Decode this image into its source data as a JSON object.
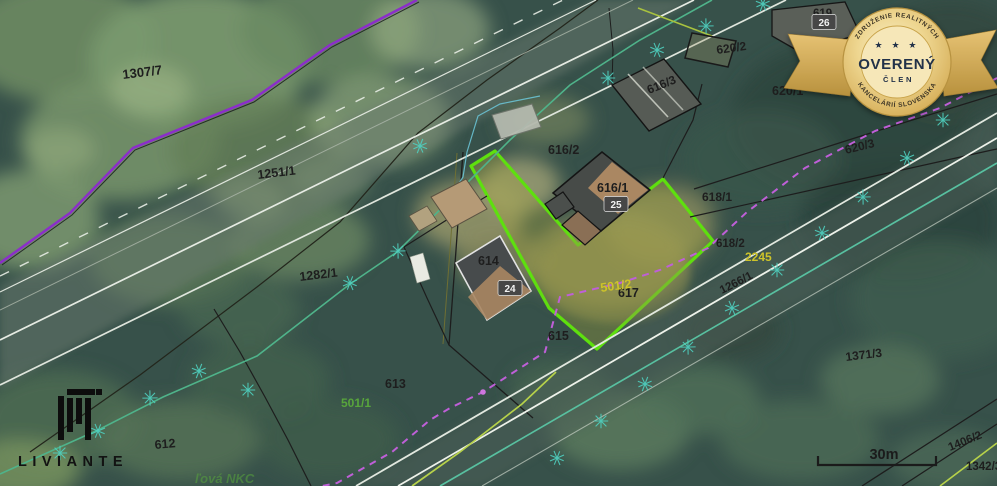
{
  "map": {
    "highlight_color": "#5ee00e",
    "boundary_purple": "#8b2fc9",
    "dashed_magenta": "#bf5fd8",
    "tree_color": "#4fd0c0",
    "label_yellow": "#cdc32a",
    "label_green": "#58a53c",
    "parcel_labels": [
      {
        "text": "1307/7",
        "x": 123,
        "y": 79,
        "color": "#1e1e1e",
        "rot": -7,
        "size": 13
      },
      {
        "text": "1251/1",
        "x": 258,
        "y": 179,
        "color": "#1e1e1e",
        "rot": -7,
        "size": 12.5
      },
      {
        "text": "1282/1",
        "x": 300,
        "y": 281,
        "color": "#1e1e1e",
        "rot": -7,
        "size": 12.5
      },
      {
        "text": "612",
        "x": 155,
        "y": 449,
        "color": "#1e1e1e",
        "rot": -5,
        "size": 12.5
      },
      {
        "text": "613",
        "x": 385,
        "y": 388,
        "color": "#1e1e1e",
        "rot": 0,
        "size": 12.5
      },
      {
        "text": "615",
        "x": 548,
        "y": 340,
        "color": "#1e1e1e",
        "rot": 0,
        "size": 12.5
      },
      {
        "text": "614",
        "x": 478,
        "y": 265,
        "color": "#1e1e1e",
        "rot": 0,
        "size": 12.5
      },
      {
        "text": "616/2",
        "x": 548,
        "y": 154,
        "color": "#1e1e1e",
        "rot": 0,
        "size": 12.5
      },
      {
        "text": "616/1",
        "x": 597,
        "y": 192,
        "color": "#1e1e1e",
        "rot": 0,
        "size": 12.5
      },
      {
        "text": "616/3",
        "x": 649,
        "y": 94,
        "color": "#1e1e1e",
        "rot": -22,
        "size": 12
      },
      {
        "text": "620/2",
        "x": 717,
        "y": 54,
        "color": "#1e1e1e",
        "rot": -8,
        "size": 12
      },
      {
        "text": "620/1",
        "x": 772,
        "y": 95,
        "color": "#1e1e1e",
        "rot": 0,
        "size": 12.5
      },
      {
        "text": "620/3",
        "x": 846,
        "y": 154,
        "color": "#1e1e1e",
        "rot": -14,
        "size": 12
      },
      {
        "text": "619",
        "x": 813,
        "y": 17,
        "color": "#1e1e1e",
        "rot": 0,
        "size": 11.5
      },
      {
        "text": "618/1",
        "x": 702,
        "y": 201,
        "color": "#1e1e1e",
        "rot": 0,
        "size": 12
      },
      {
        "text": "618/2",
        "x": 716,
        "y": 247,
        "color": "#1e1e1e",
        "rot": 0,
        "size": 11.5
      },
      {
        "text": "617",
        "x": 618,
        "y": 297,
        "color": "#1e1e1e",
        "rot": 0,
        "size": 12.5
      },
      {
        "text": "1266/1",
        "x": 722,
        "y": 294,
        "color": "#1e1e1e",
        "rot": -27,
        "size": 11.5
      },
      {
        "text": "1371/3",
        "x": 846,
        "y": 361,
        "color": "#1e1e1e",
        "rot": -7,
        "size": 12
      },
      {
        "text": "1406/2",
        "x": 950,
        "y": 451,
        "color": "#1e1e1e",
        "rot": -22,
        "size": 11.5
      },
      {
        "text": "1342/3",
        "x": 966,
        "y": 470,
        "color": "#1e1e1e",
        "rot": 0,
        "size": 11.5
      },
      {
        "text": "501/2",
        "x": 601,
        "y": 292,
        "color": "#cdc32a",
        "rot": -8,
        "size": 12.5
      },
      {
        "text": "2245",
        "x": 745,
        "y": 261,
        "color": "#cdc32a",
        "rot": 0,
        "size": 12
      },
      {
        "text": "501/1",
        "x": 341,
        "y": 407,
        "color": "#58a53c",
        "rot": 0,
        "size": 12
      },
      {
        "text": "ľová NKC",
        "x": 195,
        "y": 483,
        "color": "#58a53c",
        "rot": 0,
        "size": 13,
        "italic": true,
        "opacity": 0.55
      }
    ],
    "house_numbers": [
      {
        "text": "24",
        "x": 510,
        "y": 288
      },
      {
        "text": "25",
        "x": 616,
        "y": 204
      },
      {
        "text": "26",
        "x": 824,
        "y": 22
      }
    ],
    "trees": [
      [
        60,
        453
      ],
      [
        98,
        431
      ],
      [
        150,
        398
      ],
      [
        199,
        371
      ],
      [
        248,
        390
      ],
      [
        350,
        283
      ],
      [
        398,
        251
      ],
      [
        420,
        146
      ],
      [
        608,
        78
      ],
      [
        657,
        50
      ],
      [
        706,
        26
      ],
      [
        763,
        4
      ],
      [
        943,
        120
      ],
      [
        907,
        158
      ],
      [
        863,
        197
      ],
      [
        822,
        233
      ],
      [
        777,
        270
      ],
      [
        732,
        308
      ],
      [
        688,
        347
      ],
      [
        645,
        384
      ],
      [
        601,
        421
      ],
      [
        557,
        458
      ]
    ],
    "scale_bar": {
      "label": "30m"
    }
  },
  "badge": {
    "top_text": "ZDRUŽENIE REALITNÝCH",
    "stars": "★ ★ ★",
    "main_text": "OVERENÝ",
    "sub_text": "ČLEN",
    "bottom_text": "KANCELÁRIÍ SLOVENSKA",
    "gold": "#e3c178",
    "text_color": "#233048"
  },
  "logo": {
    "text": "LIVIANTE"
  }
}
